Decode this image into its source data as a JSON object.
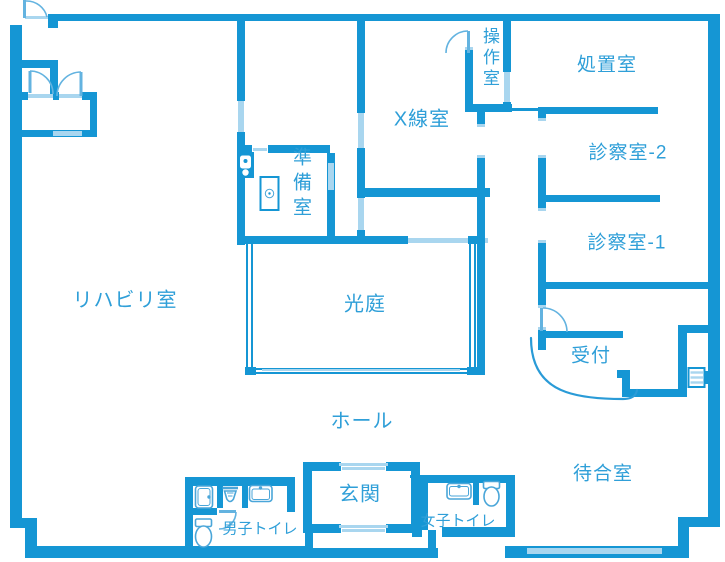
{
  "plan_title": "clinic-floor-plan",
  "colors": {
    "wall": "#1596d4",
    "window_light": "#a9d6ef",
    "fixture": "#4aa6d9",
    "label": "#2f9fd8",
    "background": "#ffffff"
  },
  "rooms": {
    "rehab": "リハビリ室",
    "prep": "準備室",
    "xray": "X線室",
    "control": "操作室",
    "treatment": "処置室",
    "exam2": "診察室-2",
    "exam1": "診察室-1",
    "court": "光庭",
    "reception": "受付",
    "hall": "ホール",
    "entrance": "玄関",
    "mens_toilet": "男子トイレ",
    "womens_toilet": "女子トイレ",
    "waiting": "待合室"
  },
  "icons": [
    "door-arc-icon",
    "sliding-door-icon",
    "window-icon",
    "sink-icon",
    "counter-sink-icon",
    "utility-sink-icon",
    "urinal-icon",
    "toilet-icon",
    "reception-counter-icon",
    "louver-vent-icon"
  ]
}
